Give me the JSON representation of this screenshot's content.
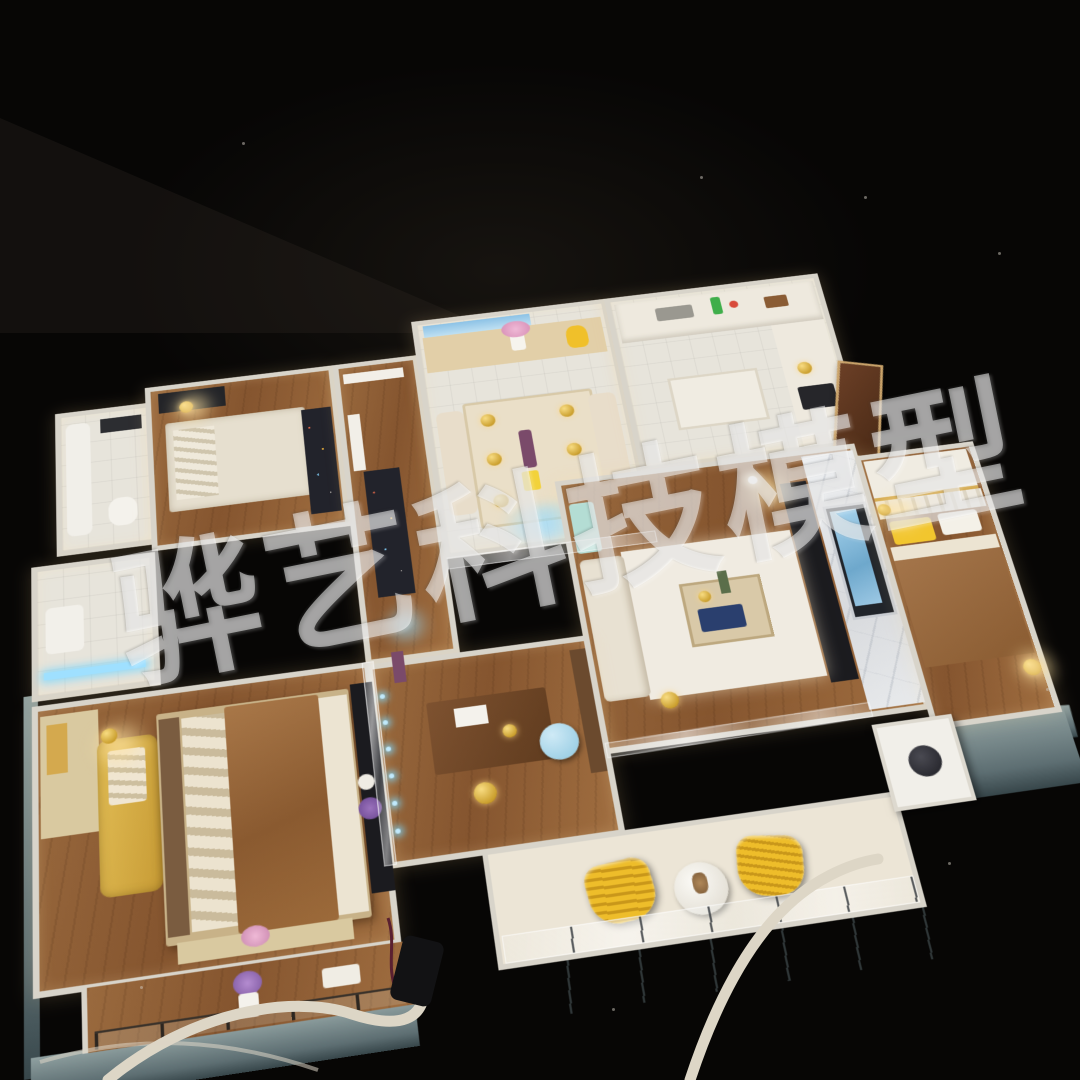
{
  "scene": {
    "type": "photograph",
    "subject": "miniature apartment interior scale model with LED lighting, viewed from above at an angle on a black tabletop",
    "background": "dark room, black backdrop with faint dust specks and white power cables in the foreground"
  },
  "watermark": {
    "text": "骅艺科技模型",
    "color": "#ffffff",
    "opacity": "0.5"
  },
  "model": {
    "rooms": [
      "master-bedroom",
      "bedroom-northwest",
      "bedroom-east",
      "living-room",
      "dining-room",
      "kitchen",
      "study",
      "bathroom-1",
      "bathroom-2",
      "corridor",
      "main-balcony",
      "master-balcony",
      "utility-corner"
    ],
    "lighting": [
      "warm interior lamp glow",
      "blue LED strips"
    ]
  },
  "palette": {
    "bg": "#070605",
    "wall": "#d8d4ca",
    "wood": "#9a6a3e",
    "tile": "#e7e4db",
    "cream": "#ece5d6",
    "gold": "#d4a94e",
    "yellow": "#eebd2a",
    "blanket": "#9d6d3e",
    "marble": "#e5e6e8",
    "screen": "#8cc2e6",
    "ledBlue": "#8fd8ff",
    "dark": "#1b1b1f",
    "base": "#5d6e72",
    "baseLight": "#8fa0a0",
    "fascia": "#d2d5cf",
    "rug": "#22232b",
    "whiteRug": "#f0ebe1",
    "cable": "#ddd6c6",
    "pink": "#e3a8c7",
    "purple": "#7e58a0",
    "green": "#3fae4a",
    "doorBrown": "#5a3320",
    "wmOpacity": "0.5"
  }
}
